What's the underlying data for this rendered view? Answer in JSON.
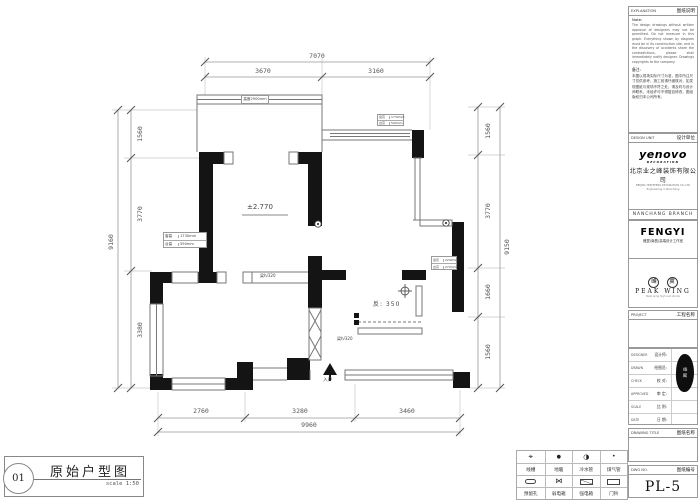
{
  "plan": {
    "dims": {
      "top_total": "7070",
      "top_segs": [
        "3670",
        "3160"
      ],
      "left_total": "9160",
      "left_segs": [
        "1560",
        "3770",
        "3380"
      ],
      "right_total": "9150",
      "right_segs": [
        "1560",
        "3770",
        "1660",
        "1560"
      ],
      "bottom_total": "9960",
      "bottom_segs": [
        "2760",
        "3280",
        "3460"
      ]
    },
    "labels": {
      "level": "±2.770",
      "sunken": "反: 350",
      "beam_a": "梁h/320",
      "beam_b": "梁h/320",
      "entry": "入户",
      "balcony_note": "高度2900mm"
    },
    "window_notes": {
      "a": {
        "r1l": "窗高",
        "r1v": "1730mm",
        "r2l": "台高",
        "r2v": "590mm"
      },
      "b": {
        "r1l": "窗高",
        "r1v": "1730mm",
        "r2l": "台高",
        "r2v": "590mm"
      },
      "c": {
        "r1l": "窗高",
        "r1v": "2290mm",
        "r2l": "台高",
        "r2v": "270mm"
      }
    }
  },
  "legend": {
    "items": [
      {
        "symbol": "crosshair-icon",
        "label": "线槽"
      },
      {
        "symbol": "filled-dot-icon",
        "label": "地暖"
      },
      {
        "symbol": "half-circle-icon",
        "label": "冷水管"
      },
      {
        "symbol": "small-dot-icon",
        "label": "煤气管"
      },
      {
        "symbol": "plug-icon",
        "label": "预留孔"
      },
      {
        "symbol": "bowtie-icon",
        "label": "弱电箱"
      },
      {
        "symbol": "rect-diagonal-icon",
        "label": "强电箱"
      },
      {
        "symbol": "rect-icon",
        "label": "门铃"
      }
    ],
    "sym1": "⌖",
    "sym2": "●",
    "sym3": "◑",
    "sym4": "•",
    "sym6": "⋈"
  },
  "caption": {
    "number": "01",
    "title": "原始户型图",
    "scale": "scale 1:50"
  },
  "titleblock": {
    "explanation_en": "EXPLANATION",
    "explanation_cn": "图纸说明",
    "note_title": "Note:",
    "note_body": "The design drawings without written approval of designers may not be permitted. Do not measure in this graph. Everything shown by diagram must be in its construction site, and in the discovery of accidents share the contradictions, please shall immediately notify designer. Drawings copyrights to the company.",
    "remark_title": "备注:",
    "remark_body": "本图以现场实际尺寸为准，图中所注尺寸仅供参考，施工前请仔细核对，如发现图纸与现场不符之处，请及时与设计师联系，未经许可不得擅自修改，图纸版权归本公司所有。",
    "design_unit_en": "DESIGN UNIT",
    "design_unit_cn": "设计单位",
    "logo_main": "yenovo",
    "logo_sub": "DECORATION",
    "company": "北京业之峰装饰有限公司",
    "addr1": "BEIJING YEZHIFENG DECORATION CO.,LTD",
    "addr2": "Engineering in Nanchang",
    "branch": "NANCHANG BRANCH",
    "fengyi_logo": "FENGYI",
    "fengyi_sub": "峰翼(南昌)高端设计工作室",
    "peak_seal_1": "峰",
    "peak_seal_2": "翼",
    "peak_en": "PEAK  WING",
    "peak_tag": "Peak wing high end studio",
    "project_en": "PROJECT",
    "project_cn": "工程名称",
    "rows": [
      {
        "en": "DESIGNER",
        "cn": "设计师:"
      },
      {
        "en": "DRAWN",
        "cn": "绘图员:"
      },
      {
        "en": "CHECK",
        "cn": "校 对:"
      },
      {
        "en": "APPROVED",
        "cn": "审 定:"
      },
      {
        "en": "SCALE",
        "cn": "比 例:"
      },
      {
        "en": "DATE",
        "cn": "日 期:"
      }
    ],
    "drawing_title_en": "DRAWING TITLE",
    "drawing_title_cn": "图纸名称",
    "dwg_no_en": "DWG NO.",
    "dwg_no_cn": "图纸编号",
    "dwg_no": "PL-5"
  }
}
